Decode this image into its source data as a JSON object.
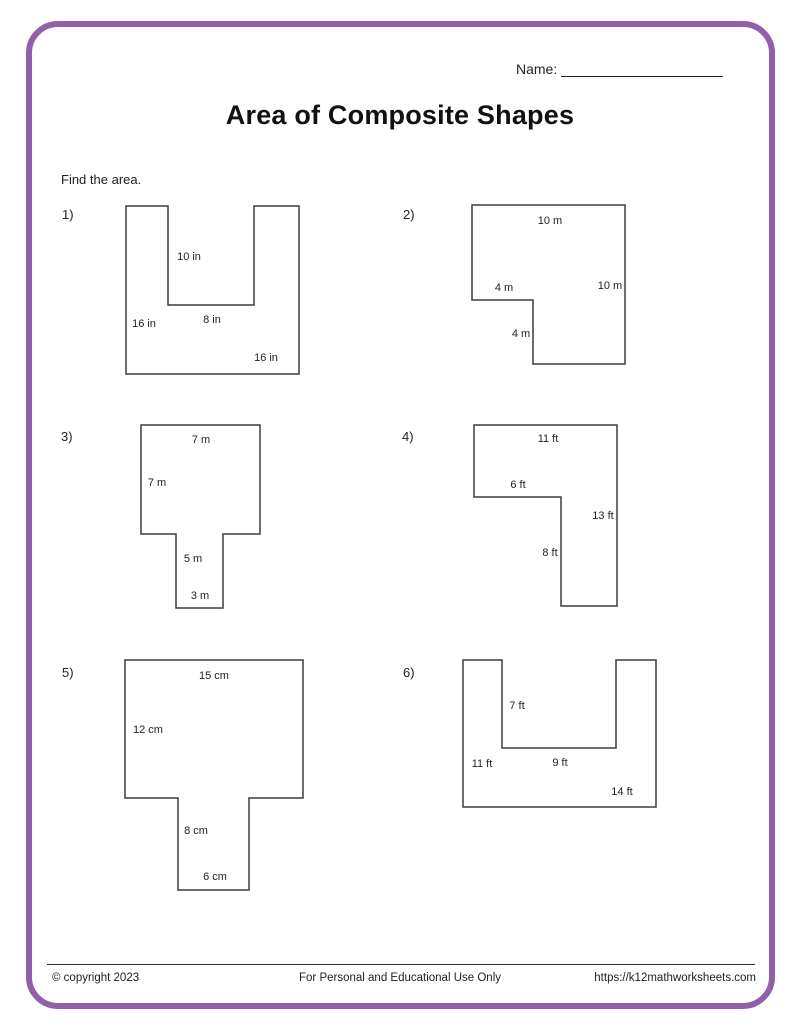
{
  "page": {
    "name_label": "Name:",
    "title": "Area of Composite Shapes",
    "instruction": "Find the area."
  },
  "problems": [
    {
      "number": "1)",
      "unit": "in",
      "labels": [
        "10 in",
        "16 in",
        "8 in",
        "16 in"
      ]
    },
    {
      "number": "2)",
      "unit": "m",
      "labels": [
        "10 m",
        "4 m",
        "10 m",
        "4 m"
      ]
    },
    {
      "number": "3)",
      "unit": "m",
      "labels": [
        "7 m",
        "7 m",
        "5 m",
        "3 m"
      ]
    },
    {
      "number": "4)",
      "unit": "ft",
      "labels": [
        "11 ft",
        "6 ft",
        "13 ft",
        "8 ft"
      ]
    },
    {
      "number": "5)",
      "unit": "cm",
      "labels": [
        "15 cm",
        "12 cm",
        "8 cm",
        "6 cm"
      ]
    },
    {
      "number": "6)",
      "unit": "ft",
      "labels": [
        "7 ft",
        "11 ft",
        "9 ft",
        "14 ft"
      ]
    }
  ],
  "footer": {
    "copyright": "© copyright 2023",
    "usage": "For Personal and Educational Use Only",
    "url": "https://k12mathworksheets.com"
  },
  "colors": {
    "frame_purple": "#9160A8",
    "shape_stroke": "#3d3d3d",
    "text": "#222222"
  }
}
